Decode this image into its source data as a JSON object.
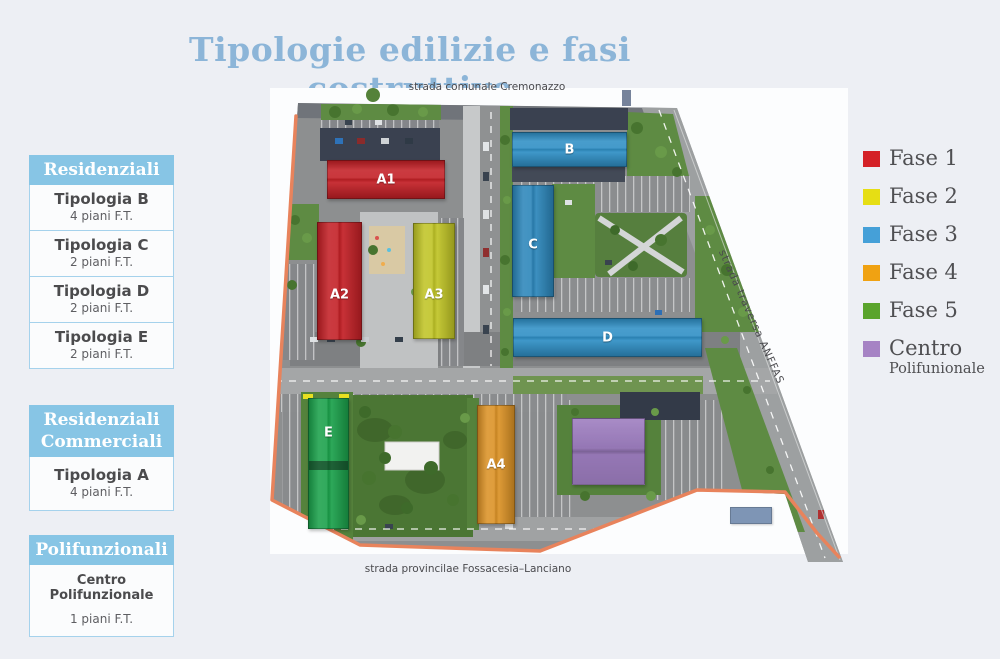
{
  "page": {
    "title": "Tipologie edilizie e fasi costruttive"
  },
  "sidebar": {
    "groups": [
      {
        "header": "Residenziali",
        "items": [
          {
            "name": "Tipologia B",
            "floors": "4 piani F.T."
          },
          {
            "name": "Tipologia C",
            "floors": "2 piani F.T."
          },
          {
            "name": "Tipologia D",
            "floors": "2 piani F.T."
          },
          {
            "name": "Tipologia E",
            "floors": "2 piani F.T."
          }
        ]
      },
      {
        "header": "Residenziali Commerciali",
        "items": [
          {
            "name": "Tipologia A",
            "floors": "4 piani F.T."
          }
        ]
      },
      {
        "header": "Polifunzionali",
        "items": [
          {
            "name": "Centro Polifunzionale",
            "floors": "1 piani F.T."
          }
        ]
      }
    ]
  },
  "legend": {
    "items": [
      {
        "label": "Fase 1",
        "color": "#d42127"
      },
      {
        "label": "Fase 2",
        "color": "#e6de14"
      },
      {
        "label": "Fase 3",
        "color": "#45a0d8"
      },
      {
        "label": "Fase 4",
        "color": "#f0a212"
      },
      {
        "label": "Fase 5",
        "color": "#5aa42c"
      },
      {
        "label": "Centro",
        "sublabel": "Polifunionale",
        "color": "#a683c4"
      }
    ]
  },
  "map": {
    "streets": {
      "top": "strada comunale Cremonazzo",
      "right": "strada traversa ANFFAS",
      "bottom": "strada provincilae Fossacesia–Lanciano"
    },
    "buildings": [
      {
        "label": "A1",
        "color": "#c32026"
      },
      {
        "label": "A2",
        "color": "#c32026"
      },
      {
        "label": "A3",
        "color": "#c0c426"
      },
      {
        "label": "B",
        "color": "#2f8fc5"
      },
      {
        "label": "C",
        "color": "#2c86ba"
      },
      {
        "label": "D",
        "color": "#2f8fc5"
      },
      {
        "label": "E",
        "color": "#1ba14b"
      },
      {
        "label": "A4",
        "color": "#db9226"
      },
      {
        "label": "",
        "color": "#9e7ec0"
      },
      {
        "label": "",
        "color": "#7e95b5"
      }
    ]
  }
}
